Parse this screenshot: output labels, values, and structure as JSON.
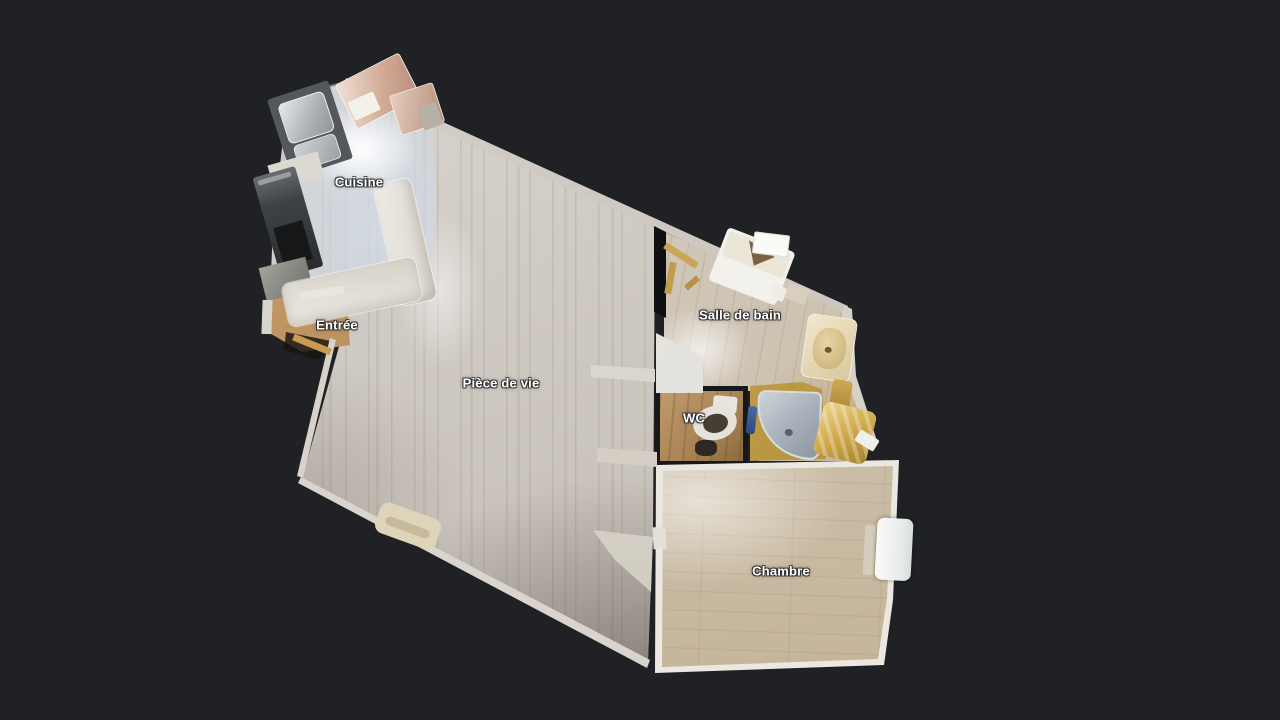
{
  "scene": {
    "background_color": "#1F2125",
    "view": "3D top-down floor plan"
  },
  "rooms": [
    {
      "id": "cuisine",
      "label": "Cuisine"
    },
    {
      "id": "entree",
      "label": "Entrée"
    },
    {
      "id": "piece_de_vie",
      "label": "Pièce de vie"
    },
    {
      "id": "salle_de_bain",
      "label": "Salle de bain"
    },
    {
      "id": "wc",
      "label": "WC"
    },
    {
      "id": "chambre",
      "label": "Chambre"
    }
  ],
  "palette": {
    "background": "#1F2125",
    "light_wood_floor": "#CFCAC3",
    "kitchen_floor": "#D6DCE6",
    "entry_wood": "#B08352",
    "bedroom_wood": "#CFC4B0",
    "wall_light": "#D4D0C9",
    "shower_gold": "#C3A04A",
    "shower_tray": "#A9B2BC",
    "label_text": "#FFFFFF"
  }
}
